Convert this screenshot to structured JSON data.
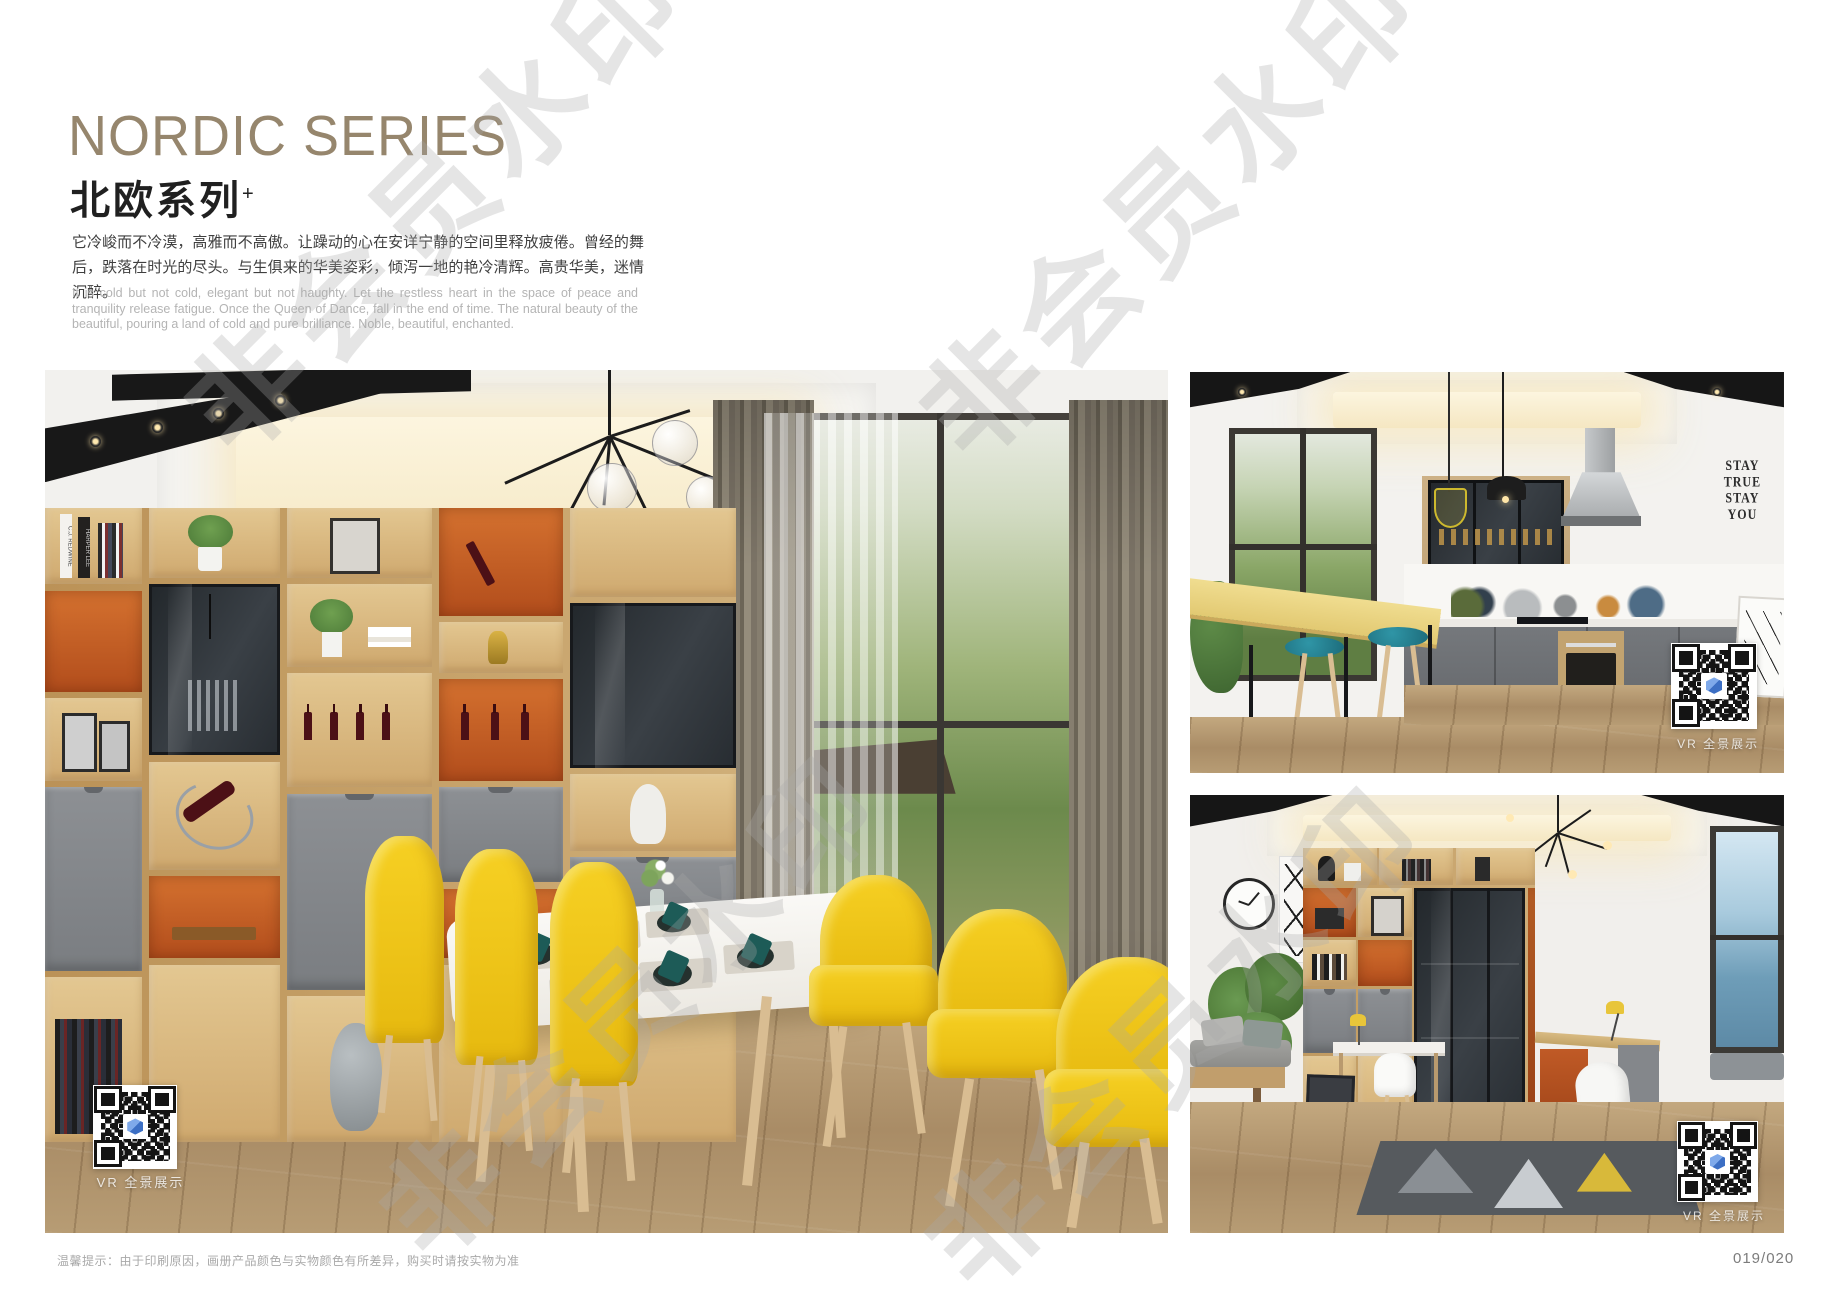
{
  "page": {
    "title_en": "NORDIC SERIES",
    "title_zh": "北欧系列",
    "title_sup": "+",
    "desc_zh": "它冷峻而不冷漠，高雅而不高傲。让躁动的心在安详宁静的空间里释放疲倦。曾经的舞后，跌落在时光的尽头。与生俱来的华美姿彩，倾泻一地的艳冷清辉。高贵华美，迷情沉醉。",
    "desc_en": "It is cold but not cold, elegant but not haughty. Let the restless heart in the space of peace and tranquility release fatigue. Once the Queen of Dance, fall in the end of time. The natural beauty of the beautiful, pouring a land of cold and pure brilliance. Noble, beautiful, enchanted.",
    "footer_note": "温馨提示：由于印刷原因，画册产品颜色与实物颜色有所差异，购买时请按实物为准",
    "page_number": "019/020",
    "watermark": "非会员水印"
  },
  "photos": {
    "dining": {
      "vr_label": "VR 全景展示",
      "book_spine_1": "C.J. REDWINE",
      "book_spine_2": "HARPER LEE"
    },
    "kitchen": {
      "vr_label": "VR 全景展示",
      "decal": [
        "STAY",
        "TRUE",
        "STAY",
        "YOU"
      ]
    },
    "study": {
      "vr_label": "VR 全景展示"
    }
  },
  "colors": {
    "title_tan": "#96866d",
    "accent_orange": "#c85a28",
    "wood_light": "#cba96f",
    "cabinet_gray": "#7e8184",
    "chair_yellow": "#f2c51d",
    "stool_teal": "#237f8e",
    "qr_logo_blue": "#4c7fd0"
  }
}
